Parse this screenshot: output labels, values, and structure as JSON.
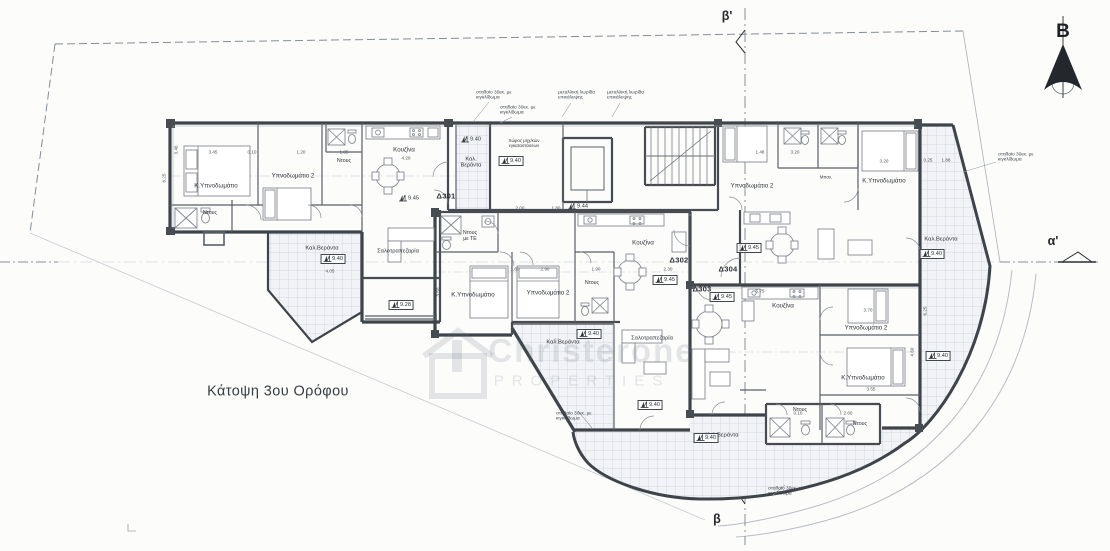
{
  "drawing": {
    "title": "Κάτοψη 3ου Ορόφου",
    "north_label": "B",
    "section_markers": {
      "top": "β'",
      "bottom": "β",
      "right": "α'"
    },
    "watermark": {
      "brand": "Christerone",
      "subtitle": "PROPERTIES"
    }
  },
  "apartments": [
    {
      "id": "Δ301",
      "x": 446,
      "y": 197
    },
    {
      "id": "Δ302",
      "x": 679,
      "y": 261
    },
    {
      "id": "Δ303",
      "x": 702,
      "y": 290
    },
    {
      "id": "Δ304",
      "x": 728,
      "y": 270
    }
  ],
  "rooms": [
    {
      "label": "Κ.Υπνοδωμάτιο",
      "x": 216,
      "y": 186
    },
    {
      "label": "Ντους",
      "x": 210,
      "y": 213,
      "s": 5.3
    },
    {
      "label": "Υπνοδωμάτιο 2",
      "x": 293,
      "y": 176
    },
    {
      "label": "Ντους",
      "x": 344,
      "y": 161,
      "s": 5.3
    },
    {
      "label": "Κουζίνα",
      "x": 404,
      "y": 150
    },
    {
      "label": "Καλ.\nΒεράντα",
      "x": 471,
      "y": 163,
      "s": 5.6
    },
    {
      "label": "Χώρος μηχ/κών\nεγκαταστάσεων",
      "x": 524,
      "y": 143,
      "s": 4.4
    },
    {
      "label": "Σαλοτραπεζαρία",
      "x": 398,
      "y": 252,
      "s": 5.8
    },
    {
      "label": "Καλ.Βεράντα",
      "x": 322,
      "y": 249,
      "s": 5.8
    },
    {
      "label": "Ντους\nμε ΤΕ",
      "x": 470,
      "y": 236,
      "s": 5.3
    },
    {
      "label": "Κ.Υπνοδωμάτιο",
      "x": 473,
      "y": 295
    },
    {
      "label": "Υπνοδωμάτιο 2",
      "x": 548,
      "y": 293
    },
    {
      "label": "Ντους",
      "x": 592,
      "y": 283,
      "s": 5.3
    },
    {
      "label": "Κουζίνα",
      "x": 643,
      "y": 243
    },
    {
      "label": "Σαλοτραπεζαρία",
      "x": 652,
      "y": 339,
      "s": 5.8
    },
    {
      "label": "Καλ.Βεράντα",
      "x": 563,
      "y": 343,
      "s": 5.8
    },
    {
      "label": "Κουζίνα",
      "x": 783,
      "y": 306
    },
    {
      "label": "Υπνοδωμάτιο 2",
      "x": 866,
      "y": 328
    },
    {
      "label": "Κ.Υπνοδωμάτιο",
      "x": 863,
      "y": 378
    },
    {
      "label": "Ντους",
      "x": 800,
      "y": 410,
      "s": 5.3
    },
    {
      "label": "Ντους",
      "x": 860,
      "y": 424,
      "s": 5.3
    },
    {
      "label": "Καλ.Βεράντα",
      "x": 722,
      "y": 436,
      "s": 5.8
    },
    {
      "label": "Υπνοδωμάτιο 2",
      "x": 752,
      "y": 186
    },
    {
      "label": "Κ.Υπνοδωμάτιο",
      "x": 884,
      "y": 181
    },
    {
      "label": "Καλ.Βεράντα",
      "x": 941,
      "y": 240,
      "s": 5.8
    },
    {
      "label": "Μπαν.",
      "x": 826,
      "y": 178,
      "s": 4.3
    }
  ],
  "levels": [
    {
      "v": "9.45",
      "x": 409,
      "y": 198,
      "boxed": false
    },
    {
      "v": "9.40",
      "x": 471,
      "y": 139,
      "boxed": false
    },
    {
      "v": "9.40",
      "x": 511,
      "y": 161,
      "boxed": true
    },
    {
      "v": "9.44",
      "x": 578,
      "y": 206,
      "boxed": false
    },
    {
      "v": "9.40",
      "x": 333,
      "y": 259,
      "boxed": true
    },
    {
      "v": "9.28",
      "x": 401,
      "y": 305,
      "boxed": true
    },
    {
      "v": "9.45",
      "x": 665,
      "y": 280,
      "boxed": true
    },
    {
      "v": "9.40",
      "x": 589,
      "y": 334,
      "boxed": true
    },
    {
      "v": "9.40",
      "x": 650,
      "y": 405,
      "boxed": true
    },
    {
      "v": "9.45",
      "x": 722,
      "y": 297,
      "boxed": true
    },
    {
      "v": "9.40",
      "x": 706,
      "y": 438,
      "boxed": true
    },
    {
      "v": "9.40",
      "x": 938,
      "y": 356,
      "boxed": true
    },
    {
      "v": "9.45",
      "x": 749,
      "y": 248,
      "boxed": true
    },
    {
      "v": "9.40",
      "x": 932,
      "y": 254,
      "boxed": true
    }
  ],
  "notes": [
    {
      "text": "στηθαίο 30εκ. με\nκιγκλίδωμα",
      "x": 476,
      "y": 96
    },
    {
      "text": "στηθαίο 30εκ. με\nκιγκλίδωμα",
      "x": 500,
      "y": 111
    },
    {
      "text": "μεταλλική λωρίδα\nεπικάλυψης",
      "x": 558,
      "y": 96
    },
    {
      "text": "μεταλλική λωρίδα\nεπικάλυψης",
      "x": 607,
      "y": 96
    },
    {
      "text": "στηθαίο 30εκ. με\nκιγκλίδωμα",
      "x": 998,
      "y": 158
    },
    {
      "text": "στηθαίο 30εκ. με\nκιγκλίδωμα",
      "x": 556,
      "y": 417
    },
    {
      "text": "στηθαίο 30εκ. με\nκιγκλίδωμα",
      "x": 768,
      "y": 492
    }
  ],
  "dims": [
    {
      "t": "3.45",
      "x": 213,
      "y": 152
    },
    {
      "t": "0.10",
      "x": 252,
      "y": 152
    },
    {
      "t": "1.20",
      "x": 301,
      "y": 152
    },
    {
      "t": "1.85",
      "x": 344,
      "y": 152
    },
    {
      "t": "4.20",
      "x": 406,
      "y": 158
    },
    {
      "t": "6.25",
      "x": 164,
      "y": 178,
      "r": 90
    },
    {
      "t": "3.40",
      "x": 176,
      "y": 150,
      "r": 90
    },
    {
      "t": "2.00",
      "x": 520,
      "y": 208
    },
    {
      "t": "1.80",
      "x": 556,
      "y": 208
    },
    {
      "t": "1.60",
      "x": 515,
      "y": 269
    },
    {
      "t": "2.90",
      "x": 545,
      "y": 269
    },
    {
      "t": "1.90",
      "x": 596,
      "y": 269
    },
    {
      "t": "2.30",
      "x": 668,
      "y": 269
    },
    {
      "t": "3.50",
      "x": 438,
      "y": 292,
      "r": 90
    },
    {
      "t": "4.05",
      "x": 330,
      "y": 271
    },
    {
      "t": "5.75",
      "x": 760,
      "y": 291
    },
    {
      "t": "3.70",
      "x": 868,
      "y": 310
    },
    {
      "t": "6.25",
      "x": 925,
      "y": 311,
      "r": 90
    },
    {
      "t": "4.60",
      "x": 912,
      "y": 352,
      "r": 90
    },
    {
      "t": "3.55",
      "x": 871,
      "y": 389
    },
    {
      "t": "0.10",
      "x": 798,
      "y": 413
    },
    {
      "t": "2.60",
      "x": 848,
      "y": 413
    },
    {
      "t": "3.20",
      "x": 795,
      "y": 152
    },
    {
      "t": "1.48",
      "x": 760,
      "y": 152
    },
    {
      "t": "3.20",
      "x": 884,
      "y": 161
    },
    {
      "t": "0.25",
      "x": 928,
      "y": 160
    },
    {
      "t": "1.88",
      "x": 946,
      "y": 160
    }
  ]
}
